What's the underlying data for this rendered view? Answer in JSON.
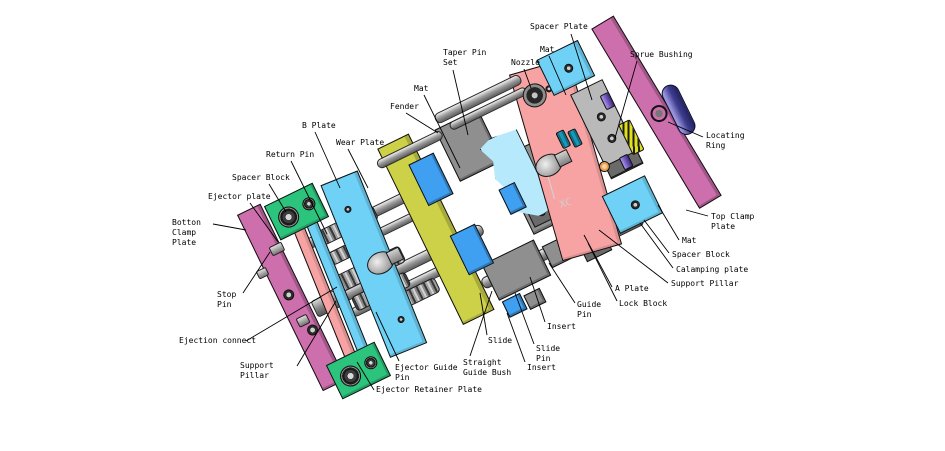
{
  "palette": {
    "bg": "#ffffff",
    "ink": "#000000",
    "magenta": "#ce6fad",
    "cyan": "#6fd1f5",
    "yellow": "#cdd148",
    "salmon": "#f7a3a3",
    "green": "#2cc47c",
    "blue": "#3f9ff0",
    "lightcyan": "#b5e9fb",
    "gray1": "#b9b9b9",
    "gray2": "#8f8f8f",
    "gray3": "#6a6a6a",
    "purple": "#7a5cc8",
    "indigo": "#3c3c8e",
    "teal": "#1899b8",
    "spring": "#e0e018",
    "orange": "#e8a050"
  },
  "diagram": {
    "watermark": {
      "text": "XC"
    },
    "labels": [
      {
        "id": "spacer-plate",
        "text": "Spacer Plate",
        "x": 530,
        "y": 22,
        "leader": [
          571,
          34,
          592,
          100
        ]
      },
      {
        "id": "mat-top",
        "text": "Mat",
        "x": 540,
        "y": 45,
        "leader": [
          549,
          56,
          566,
          95
        ]
      },
      {
        "id": "nozzle",
        "text": "Nozzle",
        "x": 511,
        "y": 58,
        "leader": [
          524,
          69,
          531,
          88
        ]
      },
      {
        "id": "taper-pin-set",
        "text": "Taper Pin\nSet",
        "x": 443,
        "y": 48,
        "leader": [
          453,
          70,
          468,
          135
        ]
      },
      {
        "id": "sprue-bushing",
        "text": "Sprue Bushing",
        "x": 630,
        "y": 50,
        "leader": [
          637,
          61,
          615,
          138
        ]
      },
      {
        "id": "mat-left",
        "text": "Mat",
        "x": 414,
        "y": 84,
        "leader": [
          424,
          95,
          460,
          168
        ]
      },
      {
        "id": "fender",
        "text": "Fender",
        "x": 390,
        "y": 102,
        "leader": [
          406,
          113,
          438,
          133
        ]
      },
      {
        "id": "b-plate",
        "text": "B Plate",
        "x": 302,
        "y": 121,
        "leader": [
          315,
          132,
          340,
          188
        ]
      },
      {
        "id": "wear-plate",
        "text": "Wear Plate",
        "x": 336,
        "y": 138,
        "leader": [
          348,
          149,
          368,
          188
        ]
      },
      {
        "id": "return-pin",
        "text": "Return Pin",
        "x": 266,
        "y": 150,
        "leader": [
          291,
          161,
          327,
          234
        ]
      },
      {
        "id": "spacer-block-left",
        "text": "Spacer Block",
        "x": 232,
        "y": 173,
        "leader": [
          269,
          184,
          286,
          212
        ]
      },
      {
        "id": "ejector-plate",
        "text": "Ejector plate",
        "x": 208,
        "y": 192,
        "leader": [
          250,
          203,
          278,
          242
        ]
      },
      {
        "id": "bottom-clamp-plate",
        "text": "Botton\nClamp\nPlate",
        "x": 172,
        "y": 218,
        "leader": [
          213,
          224,
          246,
          230
        ]
      },
      {
        "id": "stop-pin",
        "text": "Stop\nPin",
        "x": 217,
        "y": 290,
        "leader": [
          243,
          293,
          270,
          252
        ]
      },
      {
        "id": "ejection-connect",
        "text": "Ejection connect",
        "x": 179,
        "y": 336,
        "leader": [
          246,
          341,
          337,
          287
        ]
      },
      {
        "id": "support-pillar-left",
        "text": "Support\nPillar",
        "x": 240,
        "y": 361,
        "leader": [
          297,
          366,
          336,
          301
        ]
      },
      {
        "id": "ejector-retainer-plate",
        "text": "Ejector Retainer Plate",
        "x": 376,
        "y": 385,
        "leader": [
          374,
          390,
          357,
          362
        ]
      },
      {
        "id": "ejector-guide-pin",
        "text": "Ejector Guide\nPin",
        "x": 395,
        "y": 363,
        "leader": [
          399,
          361,
          376,
          312
        ]
      },
      {
        "id": "straight-guide-bush",
        "text": "Straight\nGuide Bush",
        "x": 463,
        "y": 358,
        "leader": [
          470,
          356,
          492,
          291
        ]
      },
      {
        "id": "slide",
        "text": "Slide",
        "x": 488,
        "y": 336,
        "leader": [
          487,
          335,
          480,
          293
        ]
      },
      {
        "id": "insert-bottom",
        "text": "Insert",
        "x": 527,
        "y": 363,
        "leader": [
          525,
          362,
          507,
          313
        ]
      },
      {
        "id": "slide-pin",
        "text": "Slide\nPin",
        "x": 536,
        "y": 344,
        "leader": [
          534,
          344,
          515,
          293
        ]
      },
      {
        "id": "insert-mid",
        "text": "Insert",
        "x": 547,
        "y": 322,
        "leader": [
          545,
          322,
          530,
          277
        ]
      },
      {
        "id": "guide-pin",
        "text": "Guide\nPin",
        "x": 577,
        "y": 300,
        "leader": [
          575,
          303,
          549,
          263
        ]
      },
      {
        "id": "lock-block",
        "text": "Lock Block",
        "x": 619,
        "y": 299,
        "leader": [
          617,
          301,
          588,
          243
        ]
      },
      {
        "id": "a-plate",
        "text": "A Plate",
        "x": 615,
        "y": 284,
        "leader": [
          612,
          287,
          584,
          235
        ]
      },
      {
        "id": "support-pillar-right",
        "text": "Support Pillar",
        "x": 671,
        "y": 279,
        "leader": [
          668,
          283,
          599,
          230
        ]
      },
      {
        "id": "calamping-plate",
        "text": "Calamping plate",
        "x": 676,
        "y": 265,
        "leader": [
          673,
          268,
          640,
          223
        ]
      },
      {
        "id": "spacer-block-right",
        "text": "Spacer Block",
        "x": 672,
        "y": 250,
        "leader": [
          669,
          253,
          644,
          220
        ]
      },
      {
        "id": "mat-right",
        "text": "Mat",
        "x": 682,
        "y": 236,
        "leader": [
          679,
          240,
          658,
          205
        ]
      },
      {
        "id": "top-clamp-plate",
        "text": "Top Clamp\nPlate",
        "x": 711,
        "y": 212,
        "leader": [
          708,
          216,
          686,
          210
        ]
      },
      {
        "id": "locating-ring",
        "text": "Locating\nRing",
        "x": 706,
        "y": 131,
        "leader": [
          703,
          137,
          668,
          122
        ]
      }
    ]
  }
}
